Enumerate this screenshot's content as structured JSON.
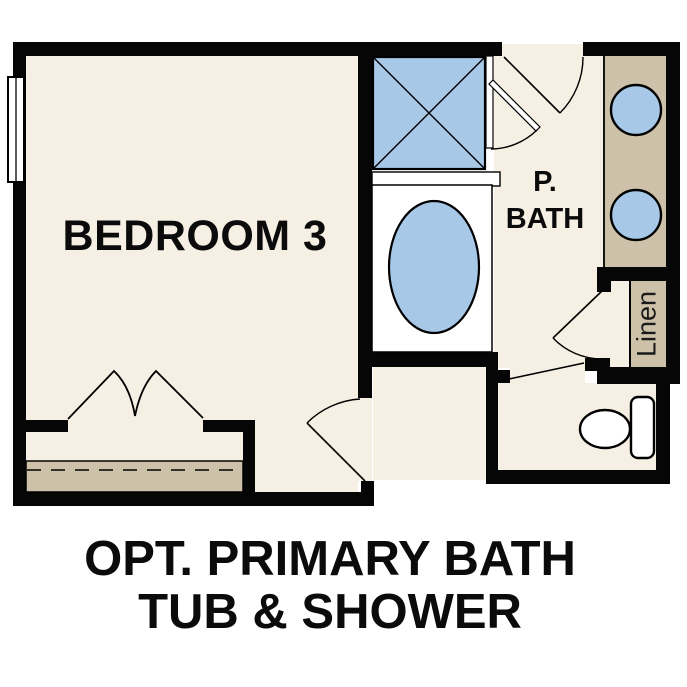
{
  "colors": {
    "floor_cream": "#f6efe3",
    "cabinet_tan": "#cdc2a9",
    "fixture_blue": "#a8c8e8",
    "wall_black": "#060606",
    "fixture_white": "#ffffff"
  },
  "rooms": {
    "bedroom": {
      "label": "BEDROOM 3"
    },
    "primary_bath": {
      "label_line1": "P.",
      "label_line2": "BATH"
    },
    "linen": {
      "label": "Linen"
    }
  },
  "caption": {
    "line1": "OPT. PRIMARY BATH",
    "line2": "TUB & SHOWER"
  }
}
